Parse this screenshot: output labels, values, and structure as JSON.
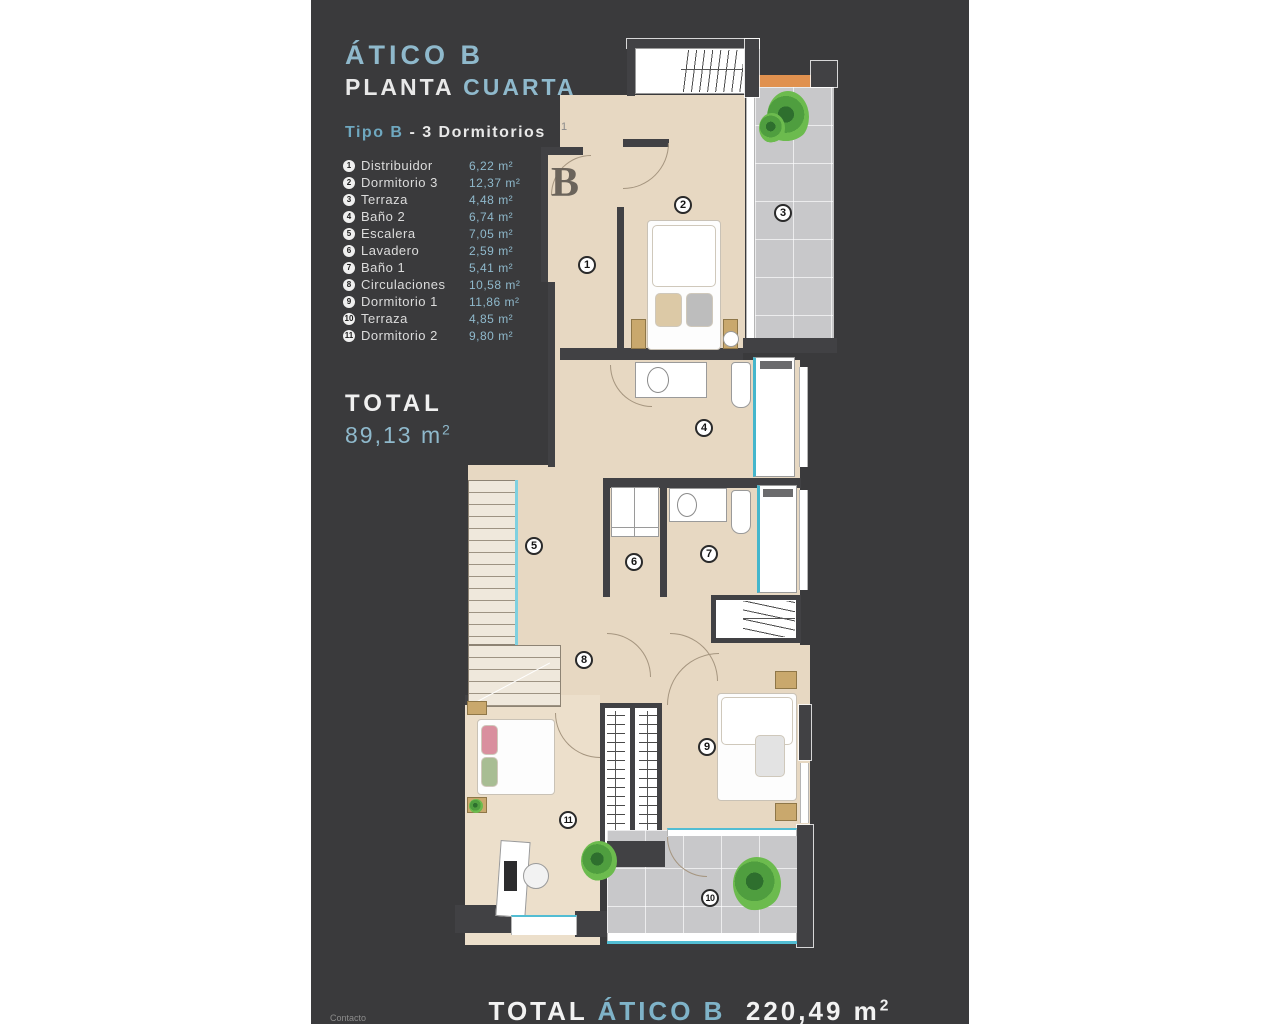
{
  "header": {
    "title": "ÁTICO B",
    "subtitle_white": "PLANTA",
    "subtitle_accent": "CUARTA",
    "type_accent": "Tipo B",
    "type_rest": "- 3 Dormitorios"
  },
  "legend": {
    "items": [
      {
        "num": "1",
        "label": "Distribuidor",
        "area": "6,22 m²"
      },
      {
        "num": "2",
        "label": "Dormitorio 3",
        "area": "12,37 m²"
      },
      {
        "num": "3",
        "label": "Terraza",
        "area": "4,48 m²"
      },
      {
        "num": "4",
        "label": "Baño 2",
        "area": "6,74 m²"
      },
      {
        "num": "5",
        "label": "Escalera",
        "area": "7,05 m²"
      },
      {
        "num": "6",
        "label": "Lavadero",
        "area": "2,59 m²"
      },
      {
        "num": "7",
        "label": "Baño 1",
        "area": "5,41 m²"
      },
      {
        "num": "8",
        "label": "Circulaciones",
        "area": "10,58 m²"
      },
      {
        "num": "9",
        "label": "Dormitorio 1",
        "area": "11,86 m²"
      },
      {
        "num": "10",
        "label": "Terraza",
        "area": "4,85 m²"
      },
      {
        "num": "11",
        "label": "Dormitorio 2",
        "area": "9,80 m²"
      }
    ]
  },
  "total": {
    "label": "TOTAL",
    "value": "89,13 m",
    "sup": "2"
  },
  "footer": {
    "contact": "Contacto",
    "label": "TOTAL",
    "name": "ÁTICO B",
    "value": "220,49 m",
    "sup": "2"
  },
  "plan": {
    "letter": "B",
    "stray_mark": "1",
    "badges": [
      "1",
      "2",
      "3",
      "4",
      "5",
      "6",
      "7",
      "8",
      "9",
      "10",
      "11"
    ]
  },
  "colors": {
    "panel_bg": "#3a3a3c",
    "accent_blue": "#8fb9cc",
    "floor_beige": "#e7d8c2",
    "terrace_gray": "#c8c8ca",
    "glass_cyan": "#52bdd3",
    "terrace_orange": "#e0914f",
    "plant_green": "#4f9e3f"
  }
}
